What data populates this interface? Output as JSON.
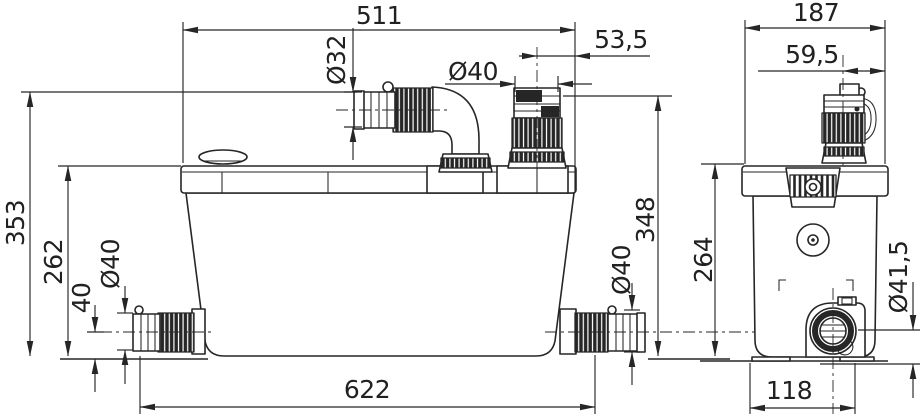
{
  "drawing": {
    "background": "#ffffff",
    "line_color": "#262626",
    "views": {
      "front": {
        "dimensions": {
          "overall_width_top": "511",
          "vent_connection_diameter": "Ø32",
          "discharge_connection_diameter": "Ø40",
          "discharge_offset_from_right": "53,5",
          "overall_height": "353",
          "tank_height": "262",
          "side_inlet_center_height": "40",
          "side_inlet_left_diameter": "Ø40",
          "side_inlet_right_diameter": "Ø40",
          "connection_height_right": "348",
          "overall_length_bottom": "622"
        }
      },
      "side": {
        "dimensions": {
          "overall_depth_top": "187",
          "discharge_center_offset": "59,5",
          "tank_height": "264",
          "outlet_diameter": "Ø41,5",
          "base_depth_bottom": "118"
        }
      }
    }
  }
}
